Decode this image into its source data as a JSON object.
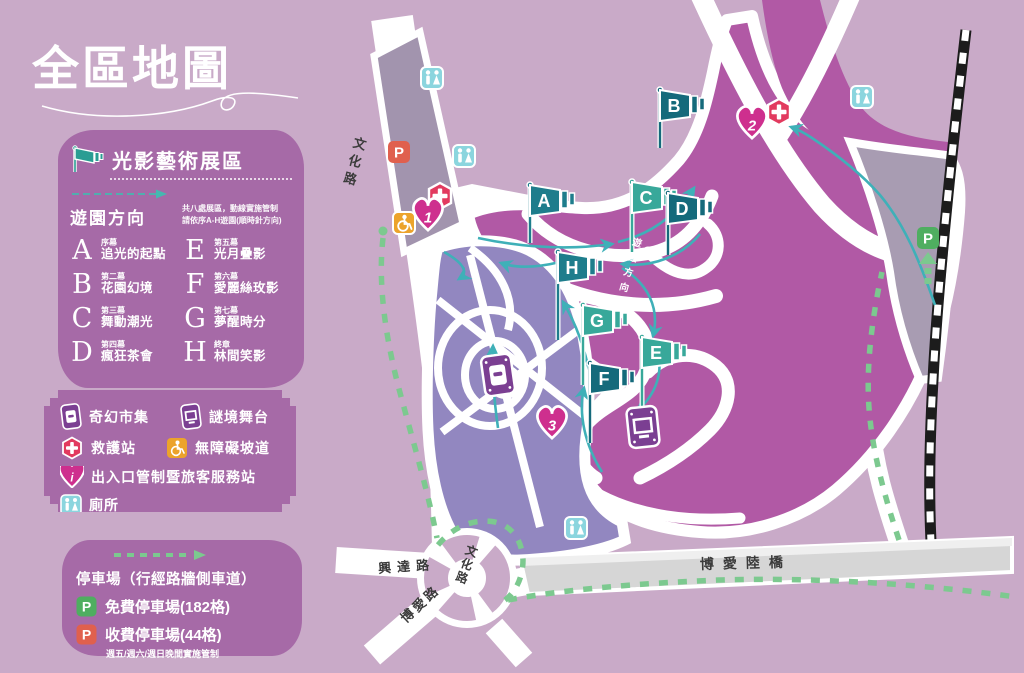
{
  "title": "全區地圖",
  "exhibit_panel": {
    "header": "光影藝術展區",
    "direction_label": "遊園方向",
    "direction_note_line1": "共八處展區，動線實施管制",
    "direction_note_line2": "請依序A-H遊園(順時針方向)",
    "acts": [
      {
        "letter": "A",
        "act": "序幕",
        "name": "追光的起點"
      },
      {
        "letter": "B",
        "act": "第二幕",
        "name": "花園幻境"
      },
      {
        "letter": "C",
        "act": "第三幕",
        "name": "舞動潮光"
      },
      {
        "letter": "D",
        "act": "第四幕",
        "name": "瘋狂茶會"
      },
      {
        "letter": "E",
        "act": "第五幕",
        "name": "光月疊影"
      },
      {
        "letter": "F",
        "act": "第六幕",
        "name": "愛麗絲玫影"
      },
      {
        "letter": "G",
        "act": "第七幕",
        "name": "夢醒時分"
      },
      {
        "letter": "H",
        "act": "終章",
        "name": "林間笑影"
      }
    ]
  },
  "legend_panel": {
    "items": [
      {
        "icon": "market-icon",
        "label": "奇幻市集"
      },
      {
        "icon": "stage-icon",
        "label": "謎境舞台"
      },
      {
        "icon": "first-aid-icon",
        "label": "救護站"
      },
      {
        "icon": "wheelchair-icon",
        "label": "無障礙坡道"
      },
      {
        "icon": "info-heart-icon",
        "label": "出入口管制暨旅客服務站"
      },
      {
        "icon": "toilet-icon",
        "label": "廁所"
      }
    ],
    "info_letter": "i"
  },
  "parking_panel": {
    "title": "停車場（行經路牆側車道）",
    "free_label": "免費停車場(182格)",
    "paid_label": "收費停車場(44格)",
    "note": "週五/週六/週日晚間實施管制",
    "p_letter": "P"
  },
  "map": {
    "road_labels": {
      "wenhua_top": "文化路",
      "wenhua_roundabout": "文化路",
      "xingda": "興達路",
      "boai": "博愛路",
      "boai_bridge": "博愛陸橋"
    },
    "route_direction_label": "遊園方向",
    "flags": [
      {
        "letter": "A"
      },
      {
        "letter": "B"
      },
      {
        "letter": "C"
      },
      {
        "letter": "D"
      },
      {
        "letter": "E"
      },
      {
        "letter": "F"
      },
      {
        "letter": "G"
      },
      {
        "letter": "H"
      }
    ],
    "station_hearts": [
      "1",
      "2",
      "3"
    ],
    "p_letter": "P"
  },
  "colors": {
    "background": "#c9aac8",
    "panel": "#a66aa7",
    "map_main": "#b159a5",
    "map_light_zone": "#9287c0",
    "grey_zone": "#a89cb2",
    "bridge": "#d6d6d6",
    "flag_dark": "#156a7b",
    "flag_mid": "#1e7d8c",
    "flag_light": "#38a89a",
    "route_teal": "#3fb0b8",
    "route_green": "#7cc98f",
    "p_free_green": "#4fae60",
    "p_paid_red": "#e0604e",
    "wheelchair_orange": "#eca32b",
    "toilet_teal": "#8bd5de",
    "first_aid_red": "#e23a5f",
    "heart_pink": "#ce2f8e",
    "market_purple": "#7b3f92"
  }
}
